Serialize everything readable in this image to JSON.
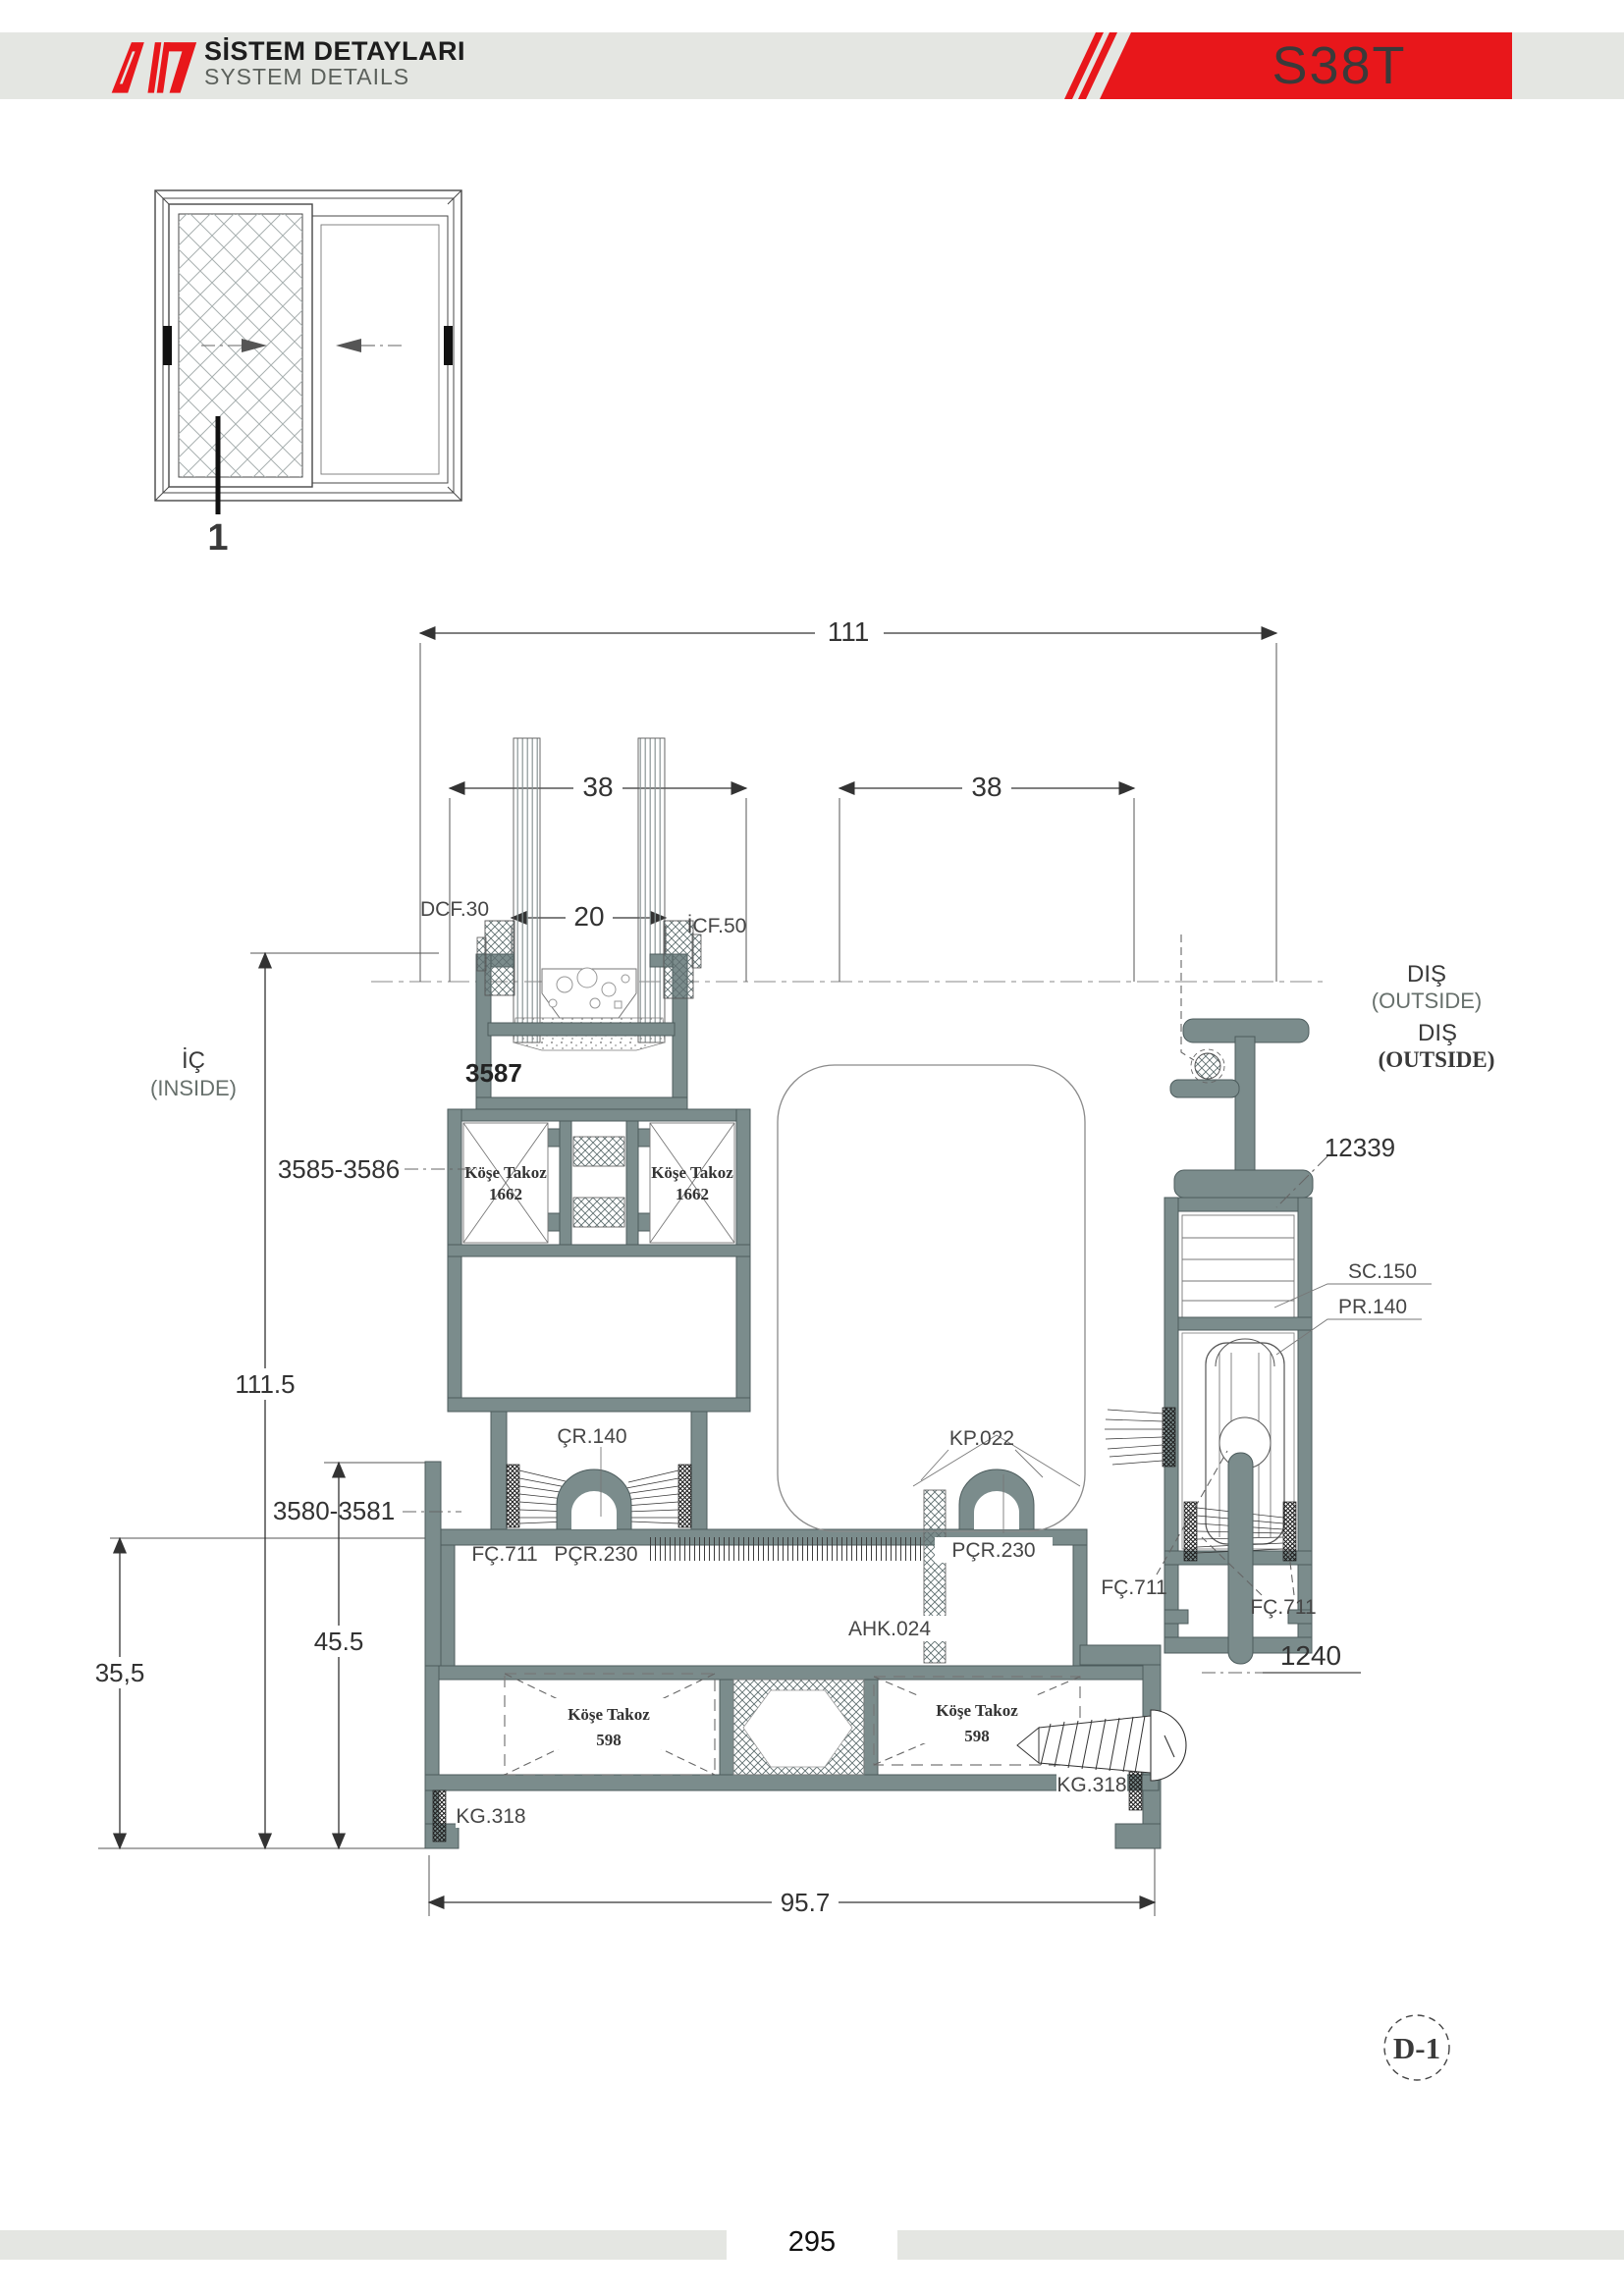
{
  "colors": {
    "accent": "#e8171b",
    "band": "#e4e6e2",
    "profile": "#7b8c8c",
    "profile-dark": "#4c5b5c",
    "ink": "#3a3a3a"
  },
  "header": {
    "title_tr": "SİSTEM DETAYLARI",
    "title_en": "SYSTEM DETAILS",
    "code": "S38T"
  },
  "elevation": {
    "callout": "1"
  },
  "section": {
    "inside_tr": "İÇ",
    "inside_en": "(INSIDE)",
    "outside_tr": "DIŞ",
    "outside_en": "(OUTSIDE)",
    "dims": {
      "total_width": "111",
      "left_sash": "38",
      "right_sash": "38",
      "glazing": "20",
      "overall_height": "111.5",
      "mid_height": "45.5",
      "low_height": "35,5",
      "sill_width": "95.7"
    },
    "profiles": {
      "glazing_bead": "3587",
      "sash_pair": "3585-3586",
      "track_pair": "3580-3581",
      "top_rail": "12339",
      "bottom_panel": "1240"
    },
    "parts": {
      "outer_glazing_gasket": "DCF.30",
      "inner_glazing_gasket": "İCF.50",
      "corner_key_small": "Köşe Takoz",
      "corner_key_small_no": "1662",
      "roller_channel": "ÇR.140",
      "cover_cap": "KP.022",
      "pile_seal": "FÇ.711",
      "track_gasket": "PÇR.230",
      "foam_tape": "AHK.024",
      "corner_key_large": "Köşe Takoz",
      "corner_key_large_no": "598",
      "glide_part": "KG.318",
      "spacer": "SC.150",
      "roller_unit": "PR.140"
    },
    "detail_ref": "D-1"
  },
  "footer": {
    "page": "295"
  }
}
